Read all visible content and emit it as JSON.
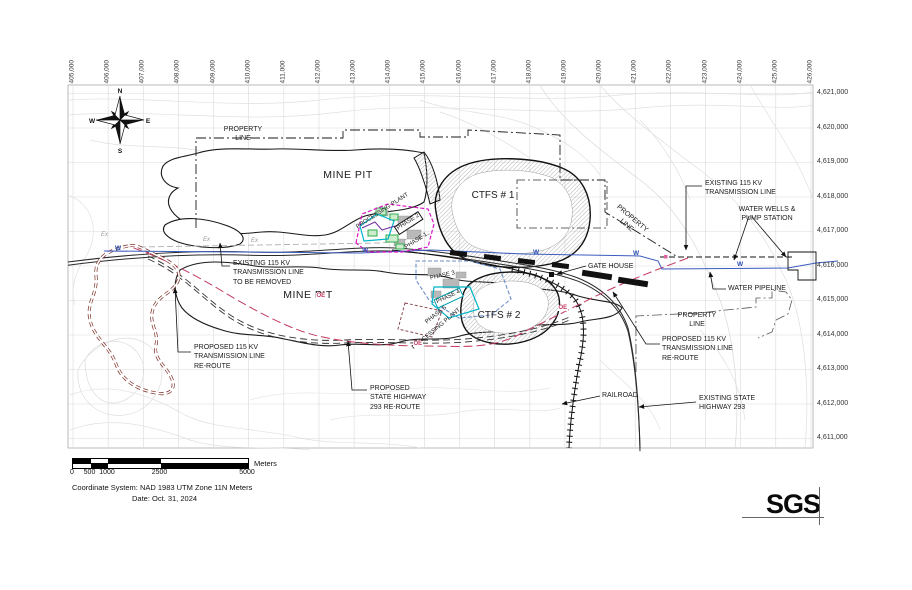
{
  "axes": {
    "top": [
      "405,000",
      "406,000",
      "407,000",
      "408,000",
      "409,000",
      "410,000",
      "411,000",
      "412,000",
      "413,000",
      "414,000",
      "415,000",
      "416,000",
      "417,000",
      "418,000",
      "419,000",
      "420,000",
      "421,000",
      "422,000",
      "423,000",
      "424,000",
      "425,000",
      "426,000"
    ],
    "right": [
      "4,621,000",
      "4,620,000",
      "4,619,000",
      "4,618,000",
      "4,617,000",
      "4,616,000",
      "4,615,000",
      "4,614,000",
      "4,613,000",
      "4,612,000",
      "4,611,000"
    ]
  },
  "compass": {
    "north": "N",
    "east": "E",
    "south": "S",
    "west": "W"
  },
  "features": {
    "property_line": "PROPERTY\nLINE",
    "mine_pit": "MINE PIT",
    "ctfs1": "CTFS # 1",
    "ctfs2": "CTFS # 2",
    "processing_plant": "PROCESSING PLANT",
    "phase1": "PHASE 1",
    "phase2": "PHASE 2",
    "phase3": "PHASE 3",
    "phase4": "PHASE 4",
    "phase5": "PHASE 5",
    "gate_house": "GATE HOUSE",
    "water_wells": "WATER WELLS &\nPUMP STATION",
    "water_pipeline": "WATER PIPELINE",
    "existing_tl": "EXISTING 115 KV\nTRANSMISSION LINE",
    "existing_tl_remove": "EXISTING 115 KV\nTRANSMISSION LINE\nTO BE REMOVED",
    "proposed_tl": "PROPOSED 115 KV\nTRANSMISSION LINE\nRE-ROUTE",
    "proposed_hwy": "PROPOSED\nSTATE HIGHWAY\n293 RE-ROUTE",
    "railroad": "RAILROAD",
    "existing_hwy": "EXISTING STATE\nHIGHWAY 293",
    "w_marker": "W",
    "oe_marker": "OE",
    "ex_marker": "Ex"
  },
  "scale_bar": {
    "ticks": [
      "0",
      "500",
      "1000",
      "2500",
      "5000"
    ],
    "unit": "Meters"
  },
  "title_block": {
    "coordinate_system": "Coordinate System: NAD 1983 UTM Zone 11N Meters",
    "date": "Date: Oct. 31, 2024",
    "logo": "SGS"
  },
  "colors": {
    "grid": "#d9d9d9",
    "contour": "#e0e0e0",
    "plant_magenta": "#d915c8",
    "plant_cyan": "#00b5c8",
    "plant_green": "#2fae4a",
    "water_blue": "#3b5bbf",
    "proposed_tl_crimson": "#c13b5e",
    "tl_loop_darkred": "#7c2d26",
    "existing_tl_gray": "#b0b0b0"
  }
}
